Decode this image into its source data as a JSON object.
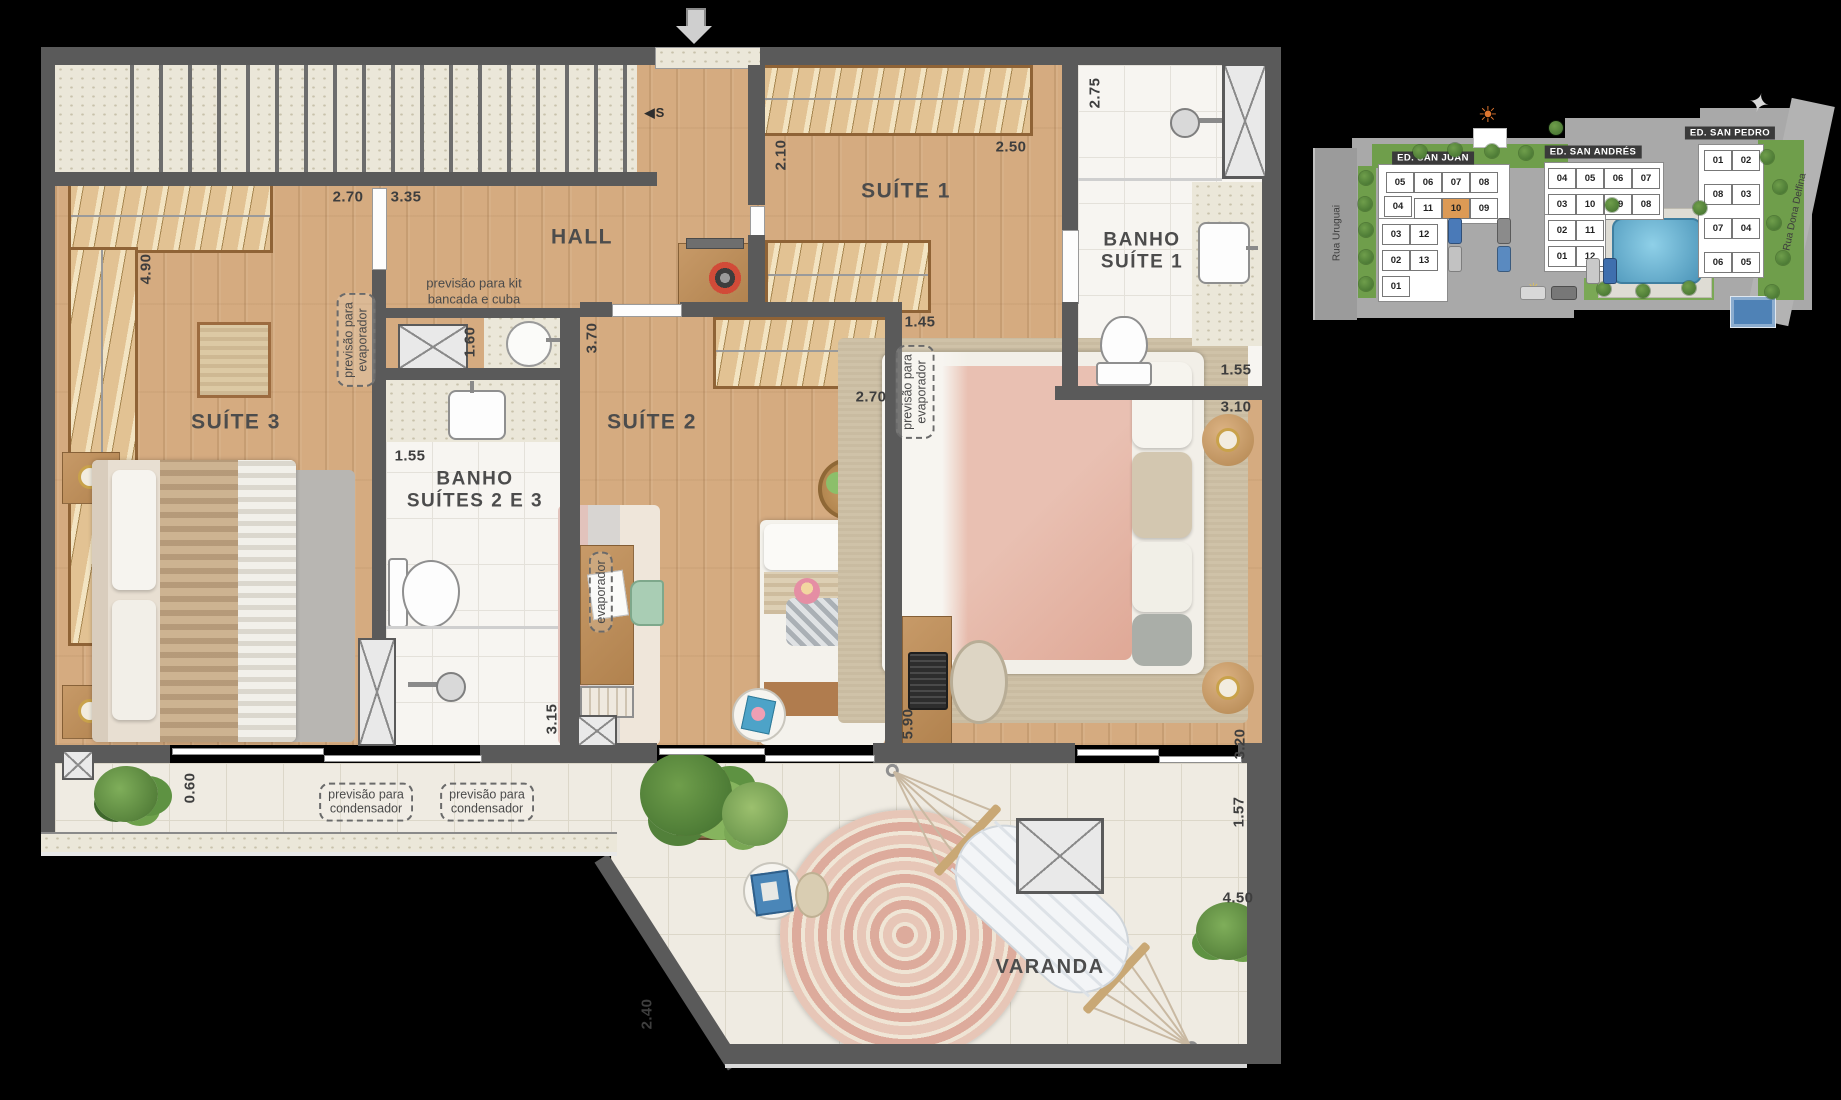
{
  "colors": {
    "wall": "#5a5a5a",
    "wood": "#d5ab80",
    "terrace_tile": "#efebe2",
    "bath_tile": "#f7f5f1",
    "closet": "#e2c293",
    "highlight_unit": "#dd9a55",
    "pool": "#62a9c9",
    "dim_text": "#3e3e3e"
  },
  "plan": {
    "room_labels": [
      {
        "name": "label-suite-3",
        "text": "SUÍTE 3",
        "x": 236,
        "y": 423,
        "fs": 21
      },
      {
        "name": "label-hall",
        "text": "HALL",
        "x": 582,
        "y": 238,
        "fs": 21
      },
      {
        "name": "label-suite-2",
        "text": "SUÍTE 2",
        "x": 652,
        "y": 423,
        "fs": 21
      },
      {
        "name": "label-suite-1",
        "text": "SUÍTE 1",
        "x": 906,
        "y": 192,
        "fs": 21
      },
      {
        "name": "label-banho-suites-2-3",
        "lines": [
          "BANHO",
          "SUÍTES 2 E 3"
        ],
        "x": 475,
        "y": 491,
        "fs": 19
      },
      {
        "name": "label-banho-suite-1",
        "lines": [
          "BANHO",
          "SUÍTE 1"
        ],
        "x": 1142,
        "y": 252,
        "fs": 19
      },
      {
        "name": "label-varanda",
        "text": "VARANDA",
        "x": 1050,
        "y": 968,
        "fs": 20
      }
    ],
    "notes": [
      {
        "name": "note-kit-bancada",
        "lines": [
          "previsão para kit",
          "bancada e cuba"
        ],
        "x": 474,
        "y": 291,
        "box": false
      },
      {
        "name": "note-evaporador-suite3",
        "lines": [
          "previsão para",
          "evaporador"
        ],
        "x": 356,
        "y": 340,
        "rot": -90,
        "box": true
      },
      {
        "name": "note-evaporador-suite1",
        "lines": [
          "previsão para",
          "evaporador"
        ],
        "x": 915,
        "y": 392,
        "rot": -90,
        "box": true
      },
      {
        "name": "note-evaporador-suite2",
        "lines": [
          "evaporador"
        ],
        "x": 601,
        "y": 592,
        "rot": -90,
        "box": true
      },
      {
        "name": "note-condensador-1",
        "lines": [
          "previsão para",
          "condensador"
        ],
        "x": 366,
        "y": 802,
        "rot": 0,
        "box": true
      },
      {
        "name": "note-condensador-2",
        "lines": [
          "previsão para",
          "condensador"
        ],
        "x": 487,
        "y": 802,
        "rot": 0,
        "box": true
      }
    ],
    "dimensions": [
      {
        "text": "2.70",
        "x": 348,
        "y": 197,
        "rot": 0
      },
      {
        "text": "3.35",
        "x": 406,
        "y": 197,
        "rot": 0
      },
      {
        "text": "4.90",
        "x": 146,
        "y": 269,
        "rot": -90
      },
      {
        "text": "2.10",
        "x": 781,
        "y": 155,
        "rot": -90
      },
      {
        "text": "2.50",
        "x": 1011,
        "y": 147,
        "rot": 0
      },
      {
        "text": "2.75",
        "x": 1095,
        "y": 93,
        "rot": -90
      },
      {
        "text": "1.60",
        "x": 470,
        "y": 342,
        "rot": -90
      },
      {
        "text": "3.70",
        "x": 592,
        "y": 338,
        "rot": -90
      },
      {
        "text": "1.55",
        "x": 410,
        "y": 456,
        "rot": 0
      },
      {
        "text": "1.45",
        "x": 920,
        "y": 322,
        "rot": 0
      },
      {
        "text": "2.70",
        "x": 871,
        "y": 397,
        "rot": 0
      },
      {
        "text": "3.10",
        "x": 1236,
        "y": 407,
        "rot": 0
      },
      {
        "text": "1.55",
        "x": 1236,
        "y": 370,
        "rot": 0
      },
      {
        "text": "5.90",
        "x": 908,
        "y": 724,
        "rot": -90
      },
      {
        "text": "3.15",
        "x": 552,
        "y": 719,
        "rot": -90
      },
      {
        "text": "3.20",
        "x": 1240,
        "y": 744,
        "rot": -90
      },
      {
        "text": "1.57",
        "x": 1239,
        "y": 812,
        "rot": -90
      },
      {
        "text": "4.50",
        "x": 1238,
        "y": 898,
        "rot": 0
      },
      {
        "text": "0.60",
        "x": 190,
        "y": 788,
        "rot": -90
      },
      {
        "text": "2.40",
        "x": 647,
        "y": 1014,
        "rot": -90
      }
    ],
    "stair_marker": {
      "arrow": "◀",
      "letter": "S",
      "x": 655,
      "y": 113
    }
  },
  "site_plan": {
    "highlighted_unit": "10",
    "streets": [
      {
        "name": "Rua Uruguai",
        "x": 1337,
        "y": 233,
        "rot": -90
      },
      {
        "name": "Rua Dona Delfina",
        "x": 1795,
        "y": 212,
        "rot": -78
      }
    ],
    "building_labels": [
      {
        "name": "ED. SAN JUAN",
        "x": 1433,
        "y": 158
      },
      {
        "name": "ED. SAN ANDRÉS",
        "x": 1593,
        "y": 152
      },
      {
        "name": "ED. SAN PEDRO",
        "x": 1730,
        "y": 133
      }
    ],
    "units": [
      {
        "b": "san-juan",
        "n": "05",
        "x": 1386,
        "y": 172
      },
      {
        "b": "san-juan",
        "n": "06",
        "x": 1414,
        "y": 172
      },
      {
        "b": "san-juan",
        "n": "07",
        "x": 1442,
        "y": 172
      },
      {
        "b": "san-juan",
        "n": "08",
        "x": 1470,
        "y": 172
      },
      {
        "b": "san-juan",
        "n": "04",
        "x": 1384,
        "y": 196
      },
      {
        "b": "san-juan",
        "n": "11",
        "x": 1414,
        "y": 198
      },
      {
        "b": "san-juan",
        "n": "10",
        "x": 1442,
        "y": 198,
        "hl": true
      },
      {
        "b": "san-juan",
        "n": "09",
        "x": 1470,
        "y": 198
      },
      {
        "b": "san-juan",
        "n": "03",
        "x": 1382,
        "y": 224
      },
      {
        "b": "san-juan",
        "n": "12",
        "x": 1410,
        "y": 224
      },
      {
        "b": "san-juan",
        "n": "02",
        "x": 1382,
        "y": 250
      },
      {
        "b": "san-juan",
        "n": "13",
        "x": 1410,
        "y": 250
      },
      {
        "b": "san-juan",
        "n": "01",
        "x": 1382,
        "y": 276
      },
      {
        "b": "san-andres",
        "n": "04",
        "x": 1548,
        "y": 168
      },
      {
        "b": "san-andres",
        "n": "05",
        "x": 1576,
        "y": 168
      },
      {
        "b": "san-andres",
        "n": "06",
        "x": 1604,
        "y": 168
      },
      {
        "b": "san-andres",
        "n": "07",
        "x": 1632,
        "y": 168
      },
      {
        "b": "san-andres",
        "n": "03",
        "x": 1548,
        "y": 194
      },
      {
        "b": "san-andres",
        "n": "10",
        "x": 1576,
        "y": 194
      },
      {
        "b": "san-andres",
        "n": "09",
        "x": 1604,
        "y": 194
      },
      {
        "b": "san-andres",
        "n": "08",
        "x": 1632,
        "y": 194
      },
      {
        "b": "san-andres",
        "n": "02",
        "x": 1548,
        "y": 220
      },
      {
        "b": "san-andres",
        "n": "11",
        "x": 1576,
        "y": 220
      },
      {
        "b": "san-andres",
        "n": "01",
        "x": 1548,
        "y": 246
      },
      {
        "b": "san-andres",
        "n": "12",
        "x": 1576,
        "y": 246
      },
      {
        "b": "san-pedro",
        "n": "01",
        "x": 1704,
        "y": 150
      },
      {
        "b": "san-pedro",
        "n": "02",
        "x": 1732,
        "y": 150
      },
      {
        "b": "san-pedro",
        "n": "08",
        "x": 1704,
        "y": 184
      },
      {
        "b": "san-pedro",
        "n": "03",
        "x": 1732,
        "y": 184
      },
      {
        "b": "san-pedro",
        "n": "07",
        "x": 1704,
        "y": 218
      },
      {
        "b": "san-pedro",
        "n": "04",
        "x": 1732,
        "y": 218
      },
      {
        "b": "san-pedro",
        "n": "06",
        "x": 1704,
        "y": 252
      },
      {
        "b": "san-pedro",
        "n": "05",
        "x": 1732,
        "y": 252
      }
    ],
    "trees": [
      [
        1366,
        178
      ],
      [
        1365,
        204
      ],
      [
        1366,
        230
      ],
      [
        1366,
        257
      ],
      [
        1366,
        284
      ],
      [
        1420,
        152
      ],
      [
        1455,
        150
      ],
      [
        1492,
        151
      ],
      [
        1526,
        153
      ],
      [
        1556,
        128
      ],
      [
        1604,
        289
      ],
      [
        1643,
        291
      ],
      [
        1689,
        288
      ],
      [
        1767,
        157
      ],
      [
        1780,
        187
      ],
      [
        1774,
        223
      ],
      [
        1783,
        258
      ],
      [
        1772,
        292
      ],
      [
        1612,
        205
      ],
      [
        1700,
        208
      ]
    ],
    "cars": [
      [
        1448,
        218,
        12,
        24,
        "#4a7ab8"
      ],
      [
        1448,
        246,
        12,
        24,
        "#c2c2c2"
      ],
      [
        1497,
        218,
        12,
        24,
        "#8b8b8b"
      ],
      [
        1497,
        246,
        12,
        24,
        "#5a8ac0"
      ],
      [
        1520,
        286,
        24,
        12,
        "#d8d8d8"
      ],
      [
        1551,
        286,
        24,
        12,
        "#777777"
      ],
      [
        1586,
        258,
        12,
        24,
        "#c9c9c9"
      ],
      [
        1603,
        258,
        12,
        24,
        "#3f6fae"
      ]
    ]
  }
}
